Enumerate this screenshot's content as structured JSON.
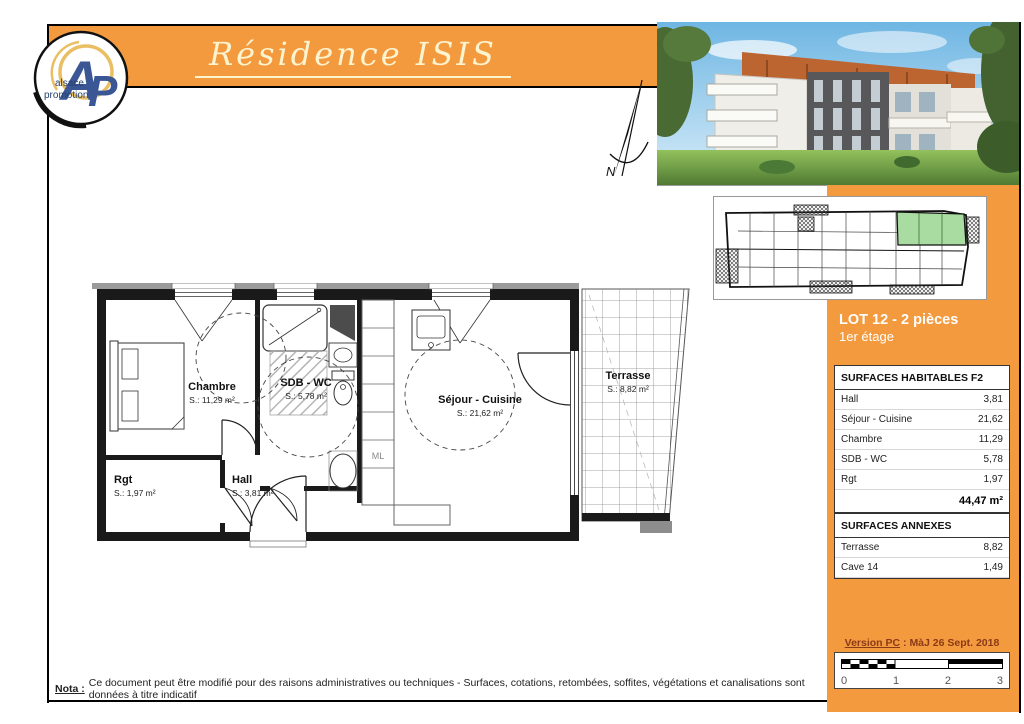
{
  "header": {
    "title": "Résidence ISIS"
  },
  "logo": {
    "monogram_a": "A",
    "monogram_p": "P",
    "line1": "alsace",
    "line2": "promotion"
  },
  "north": {
    "label": "N"
  },
  "sidebar": {
    "lot_title": "LOT 12 - 2 pièces",
    "floor_label": "1er étage",
    "habitables": {
      "title": "SURFACES HABITABLES F2",
      "rows": [
        {
          "label": "Hall",
          "value": "3,81"
        },
        {
          "label": "Séjour - Cuisine",
          "value": "21,62"
        },
        {
          "label": "Chambre",
          "value": "11,29"
        },
        {
          "label": "SDB - WC",
          "value": "5,78"
        },
        {
          "label": "Rgt",
          "value": "1,97"
        }
      ],
      "total": "44,47 m²"
    },
    "annexes": {
      "title": "SURFACES ANNEXES",
      "rows": [
        {
          "label": "Terrasse",
          "value": "8,82"
        },
        {
          "label": "Cave 14",
          "value": "1,49"
        }
      ]
    },
    "version_label": "Version PC",
    "version_rest": " : MàJ 26 Sept. 2018",
    "scale_ticks": [
      "0",
      "1",
      "2",
      "3"
    ]
  },
  "plan": {
    "rooms": [
      {
        "name": "Chambre",
        "area": "S.: 11,29 m²"
      },
      {
        "name": "SDB - WC",
        "area": "S.: 5,78 m²"
      },
      {
        "name": "Séjour - Cuisine",
        "area": "S.: 21,62 m²"
      },
      {
        "name": "Terrasse",
        "area": "S.: 8,82 m²"
      },
      {
        "name": "Rgt",
        "area": "S.: 1,97 m²"
      },
      {
        "name": "Hall",
        "area": "S.: 3,81 m²"
      }
    ],
    "ml_label": "ML"
  },
  "footer": {
    "nota_label": "Nota :",
    "nota_text": "Ce document peut être modifié pour des raisons administratives ou techniques - Surfaces, cotations, retombées, soffites, végétations et canalisations sont données à titre indicatif"
  },
  "colors": {
    "orange": "#F49A3E",
    "unit_green": "#A9DCA0"
  }
}
